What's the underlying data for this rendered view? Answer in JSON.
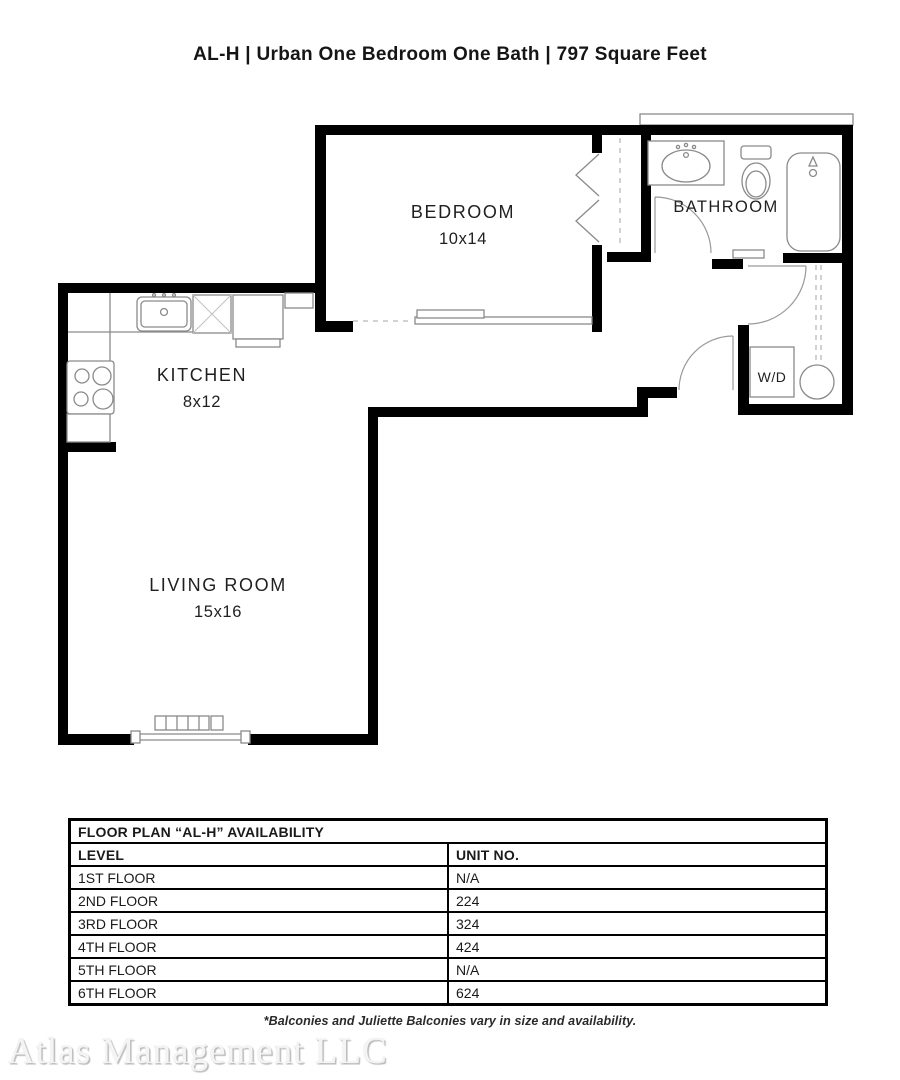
{
  "title": "AL-H | Urban One Bedroom One Bath | 797 Square Feet",
  "rooms": {
    "bedroom": {
      "name": "BEDROOM",
      "dims": "10x14"
    },
    "bathroom": {
      "name": "BATHROOM"
    },
    "kitchen": {
      "name": "KITCHEN",
      "dims": "8x12"
    },
    "living": {
      "name": "LIVING ROOM",
      "dims": "15x16"
    },
    "laundry": {
      "name": "W/D"
    }
  },
  "availability": {
    "title": "FLOOR PLAN “AL-H” AVAILABILITY",
    "columns": [
      "LEVEL",
      "UNIT NO."
    ],
    "rows": [
      [
        "1ST FLOOR",
        "N/A"
      ],
      [
        "2ND FLOOR",
        "224"
      ],
      [
        "3RD FLOOR",
        "324"
      ],
      [
        "4TH FLOOR",
        "424"
      ],
      [
        "5TH FLOOR",
        "N/A"
      ],
      [
        "6TH FLOOR",
        "624"
      ]
    ]
  },
  "footnote": "*Balconies and Juliette Balconies vary in size and availability.",
  "watermark": "Atlas Management LLC",
  "colors": {
    "wall": "#000000",
    "fixture": "#8a8a8a",
    "text": "#1a1a1a"
  }
}
